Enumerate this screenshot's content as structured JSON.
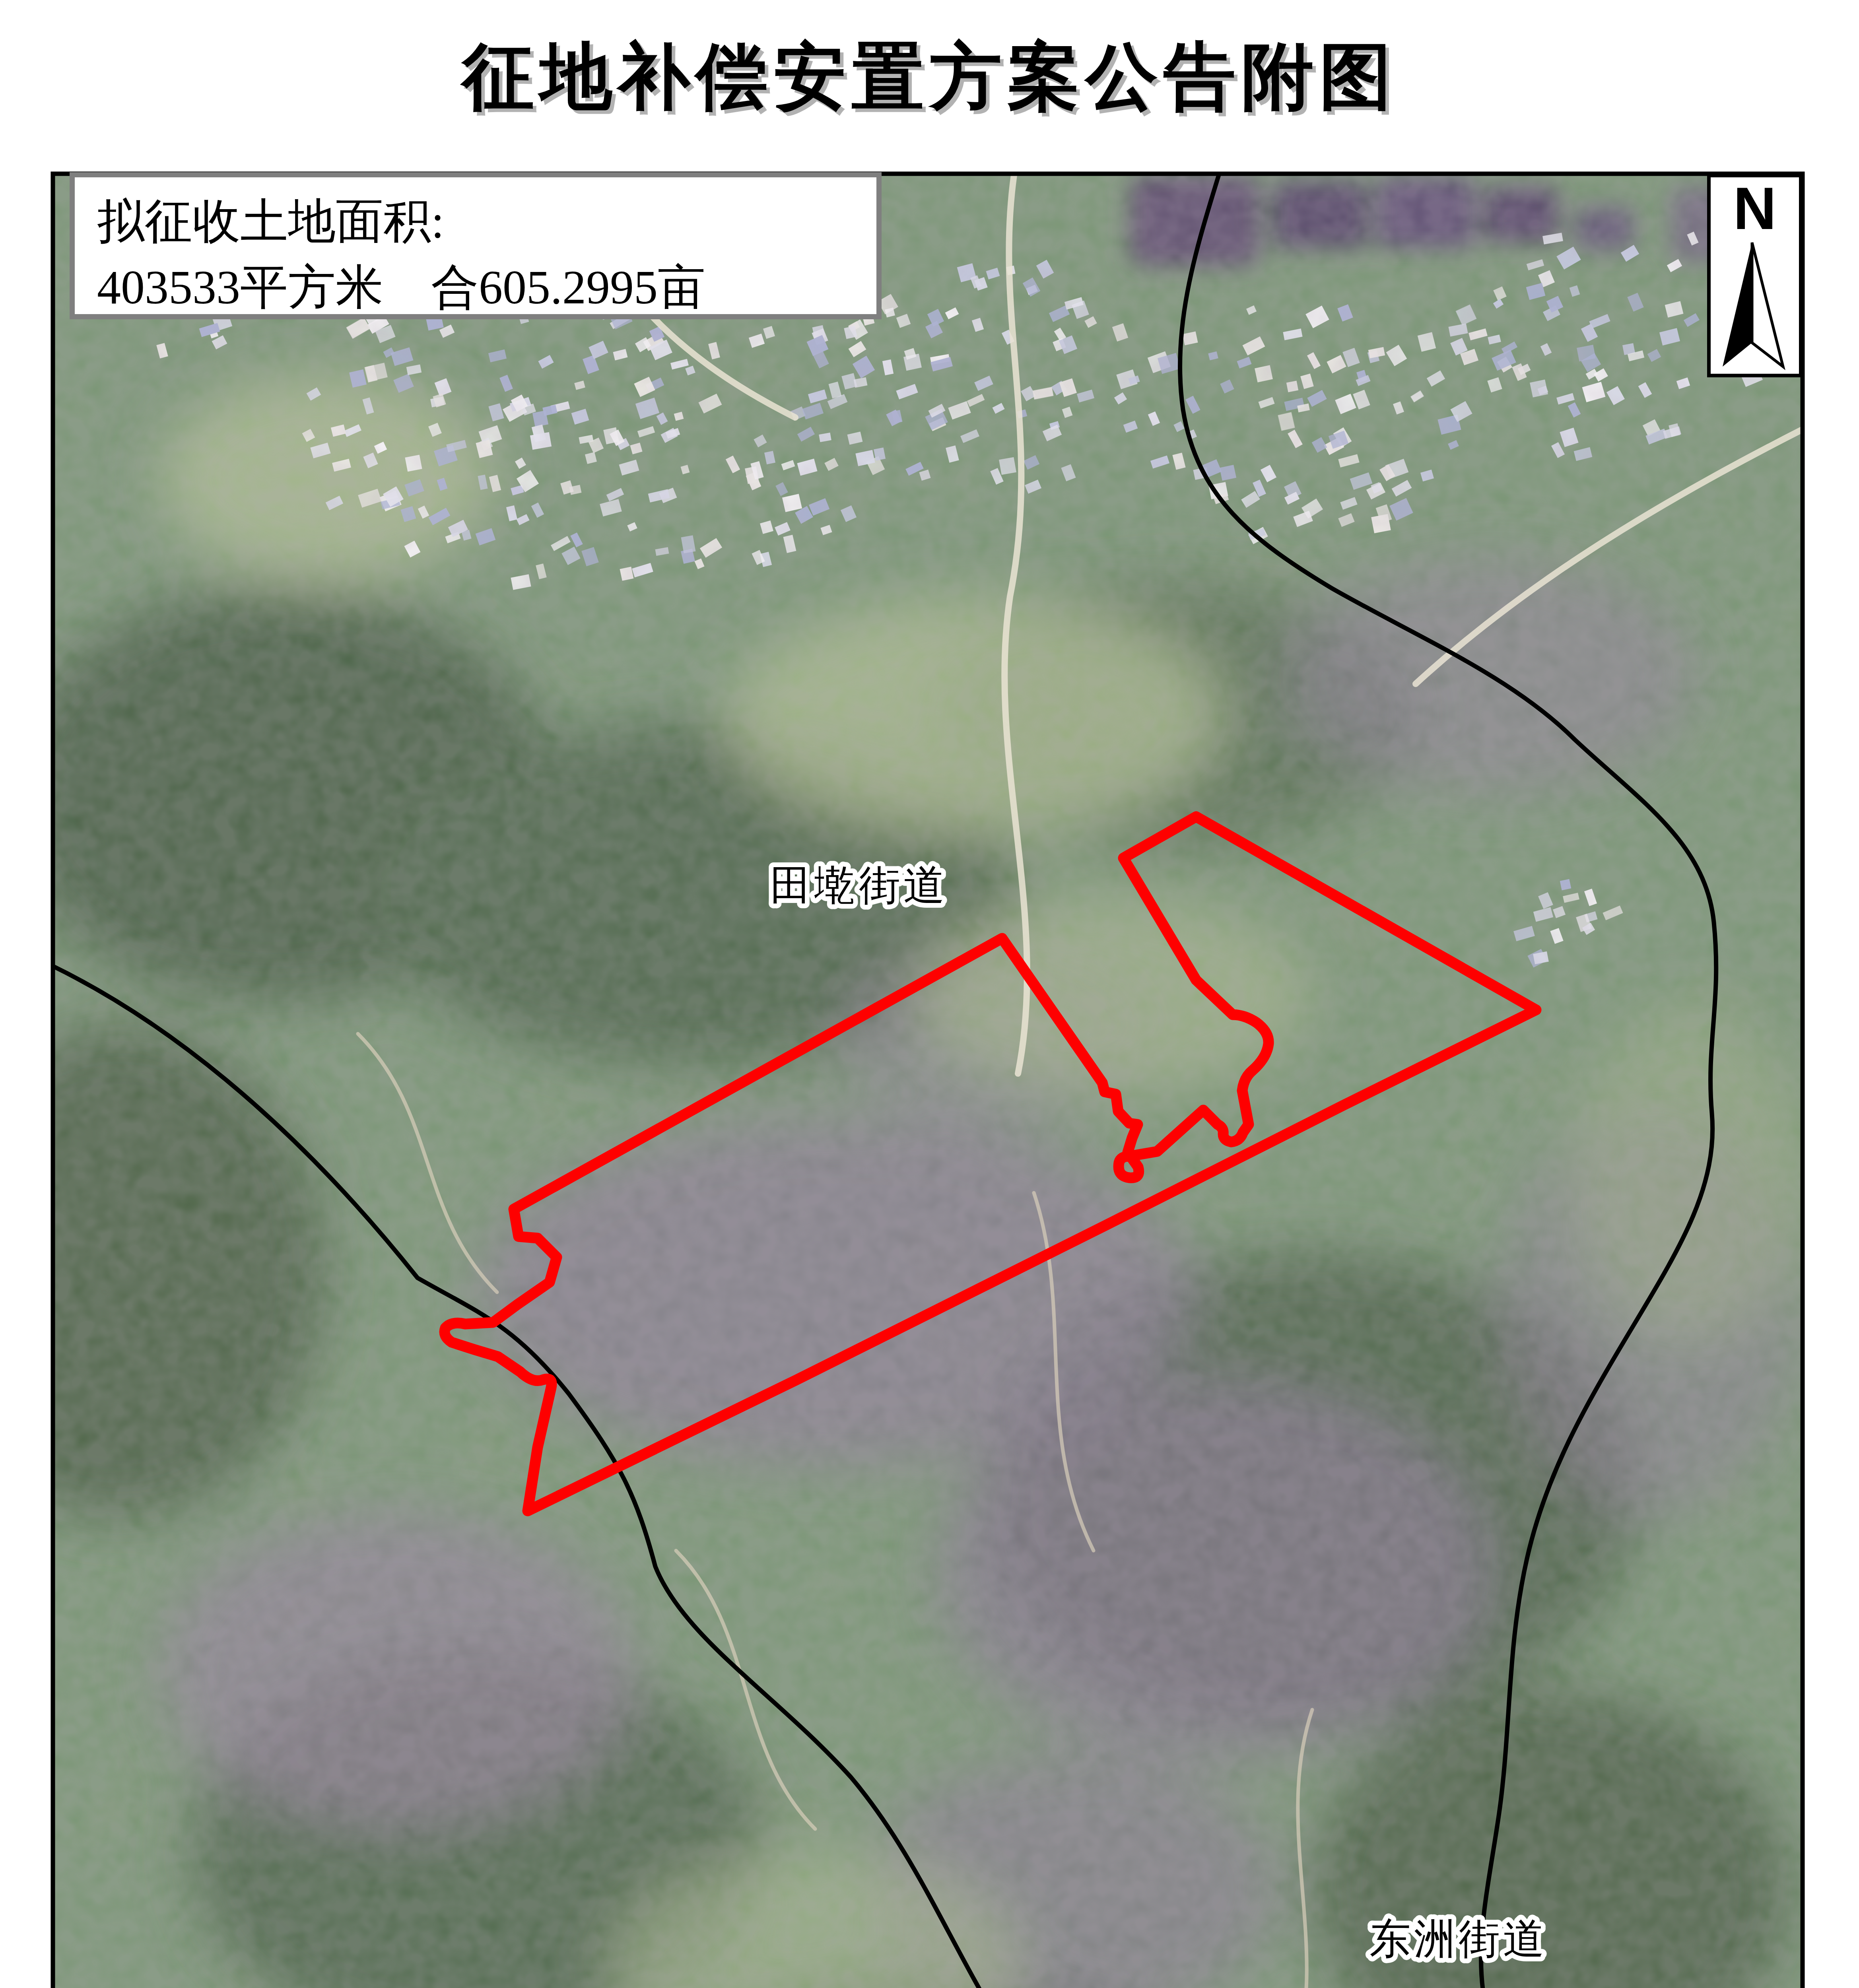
{
  "page": {
    "title": "\u5f81\u5730\u8865\u507f\u5b89\u7f6e\u65b9\u6848\u516c\u544a\u9644\u56fe",
    "scale_text": "1:8,000"
  },
  "info_box": {
    "line1": "\u62df\u5f81\u6536\u571f\u5730\u9762\u79ef:",
    "line2": "403533\u5e73\u65b9\u7c73\u3000\u5408605.2995\u4ea9"
  },
  "north_arrow": {
    "label": "N"
  },
  "map": {
    "boundary_color": "#fe0000",
    "street_line_color": "#000000",
    "region_labels": [
      {
        "name": "tianqian-street",
        "text": "\u7530\u5898\u8857\u9053"
      },
      {
        "name": "dongzhou-street",
        "text": "\u4e1c\u6d32\u8857\u9053"
      }
    ]
  },
  "legend": {
    "title": "\u56fe\u3000\u4f8b",
    "items": [
      {
        "label": "\u62df\u5f81\u5730\u8303\u56f4"
      },
      {
        "label": "\u8857\u9053\u754c\u7ebf"
      }
    ]
  }
}
